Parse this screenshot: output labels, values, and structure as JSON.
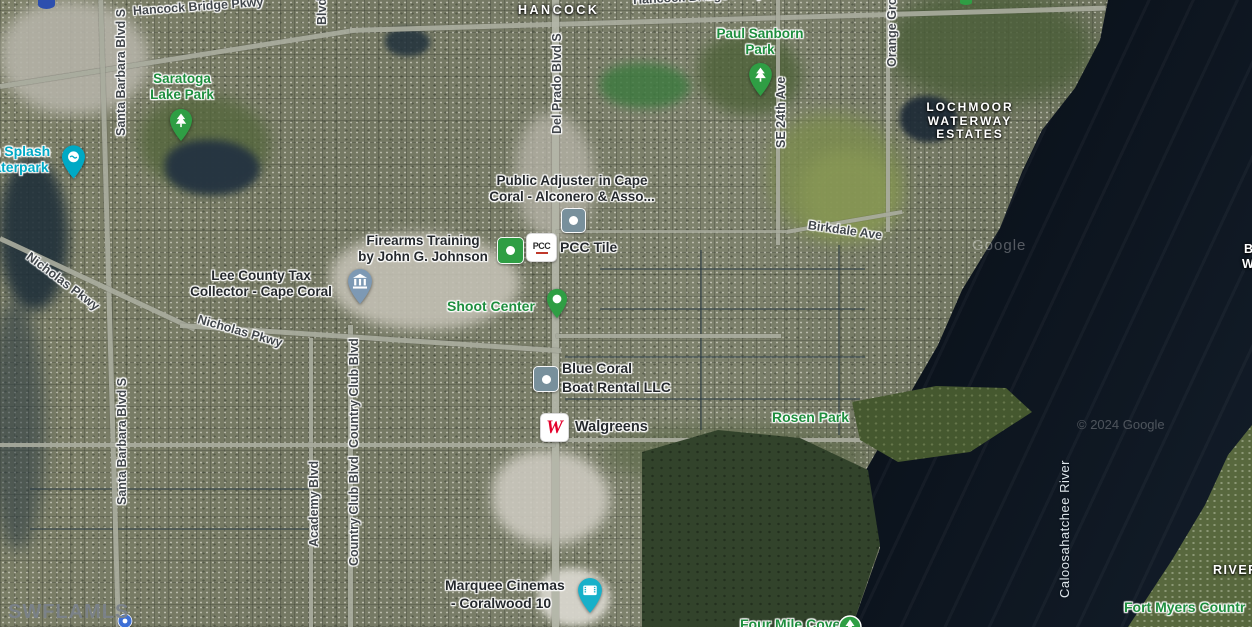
{
  "attribution": {
    "mls_watermark": "SWFLAMLS",
    "google_watermark": "Google",
    "copyright_watermark": "© 2024 Google"
  },
  "area_labels": {
    "hancock": "HANCOCK",
    "lochmoor_line1": "LOCHMOOR",
    "lochmoor_line2": "WATERWAY",
    "lochmoor_line3": "ESTATES",
    "river_partial": "RIVER",
    "edge_partial_line1": "B",
    "edge_partial_line2": "W"
  },
  "street_labels": {
    "hancock_bridge_pkwy_west": "Hancock Bridge Pkwy",
    "hancock_bridge_pkwy_east": "Hancock Bridge Pkwy",
    "santa_barbara_north": "Santa Barbara Blvd S",
    "santa_barbara_south": "Santa Barbara Blvd S",
    "nicholas_pkwy_west": "Nicholas Pkwy",
    "nicholas_pkwy_east": "Nicholas Pkwy",
    "del_prado": "Del Prado Blvd S",
    "se_24th": "SE 24th Ave",
    "orange_grove_partial": "Orange Gro",
    "birkdale": "Birkdale Ave",
    "academy": "Academy Blvd",
    "country_club_north": "Country Club Blvd",
    "country_club_south": "Country Club Blvd",
    "blvd_partial": "Blvd",
    "caloosahatchee_river": "Caloosahatchee River"
  },
  "pois": {
    "saratoga_lake_park": {
      "line1": "Saratoga",
      "line2": "Lake Park"
    },
    "paul_sanborn_park": {
      "line1": "Paul Sanborn",
      "line2": "Park"
    },
    "sun_splash_waterpark": {
      "line1": "n Splash",
      "line2": "aterpark"
    },
    "public_adjuster": {
      "line1": "Public Adjuster in Cape",
      "line2": "Coral - Alconero & Asso..."
    },
    "firearms_training": {
      "line1": "Firearms Training",
      "line2": "by John G. Johnson"
    },
    "pcc_tile": {
      "label": "PCC Tile",
      "logo_text": "PCC"
    },
    "lee_county_tax": {
      "line1": "Lee County Tax",
      "line2": "Collector - Cape Coral"
    },
    "shoot_center": {
      "label": "Shoot Center"
    },
    "blue_coral_boat_rental": {
      "line1": "Blue Coral",
      "line2": "Boat Rental LLC"
    },
    "walgreens": {
      "label": "Walgreens",
      "logo_text": "W"
    },
    "rosen_park": {
      "label": "Rosen Park"
    },
    "marquee_cinemas": {
      "line1": "Marquee Cinemas",
      "line2": "- Coralwood 10"
    },
    "four_mile_cove": {
      "label": "Four Mile Cove"
    },
    "fort_myers_country_partial": {
      "label": "Fort Myers Countr"
    }
  },
  "colors": {
    "park_label_green": "#1e8e3e",
    "attraction_teal": "#00a9c5",
    "pin_green": "#2f9e44",
    "marker_gray": "#78909c",
    "bank_pin_blue": "#7d99b4",
    "cinema_pin_teal": "#17b0c9",
    "walgreens_red": "#e4002b",
    "poi_marker_blue": "#3d6fd6",
    "water_dark": "#0e151e"
  }
}
